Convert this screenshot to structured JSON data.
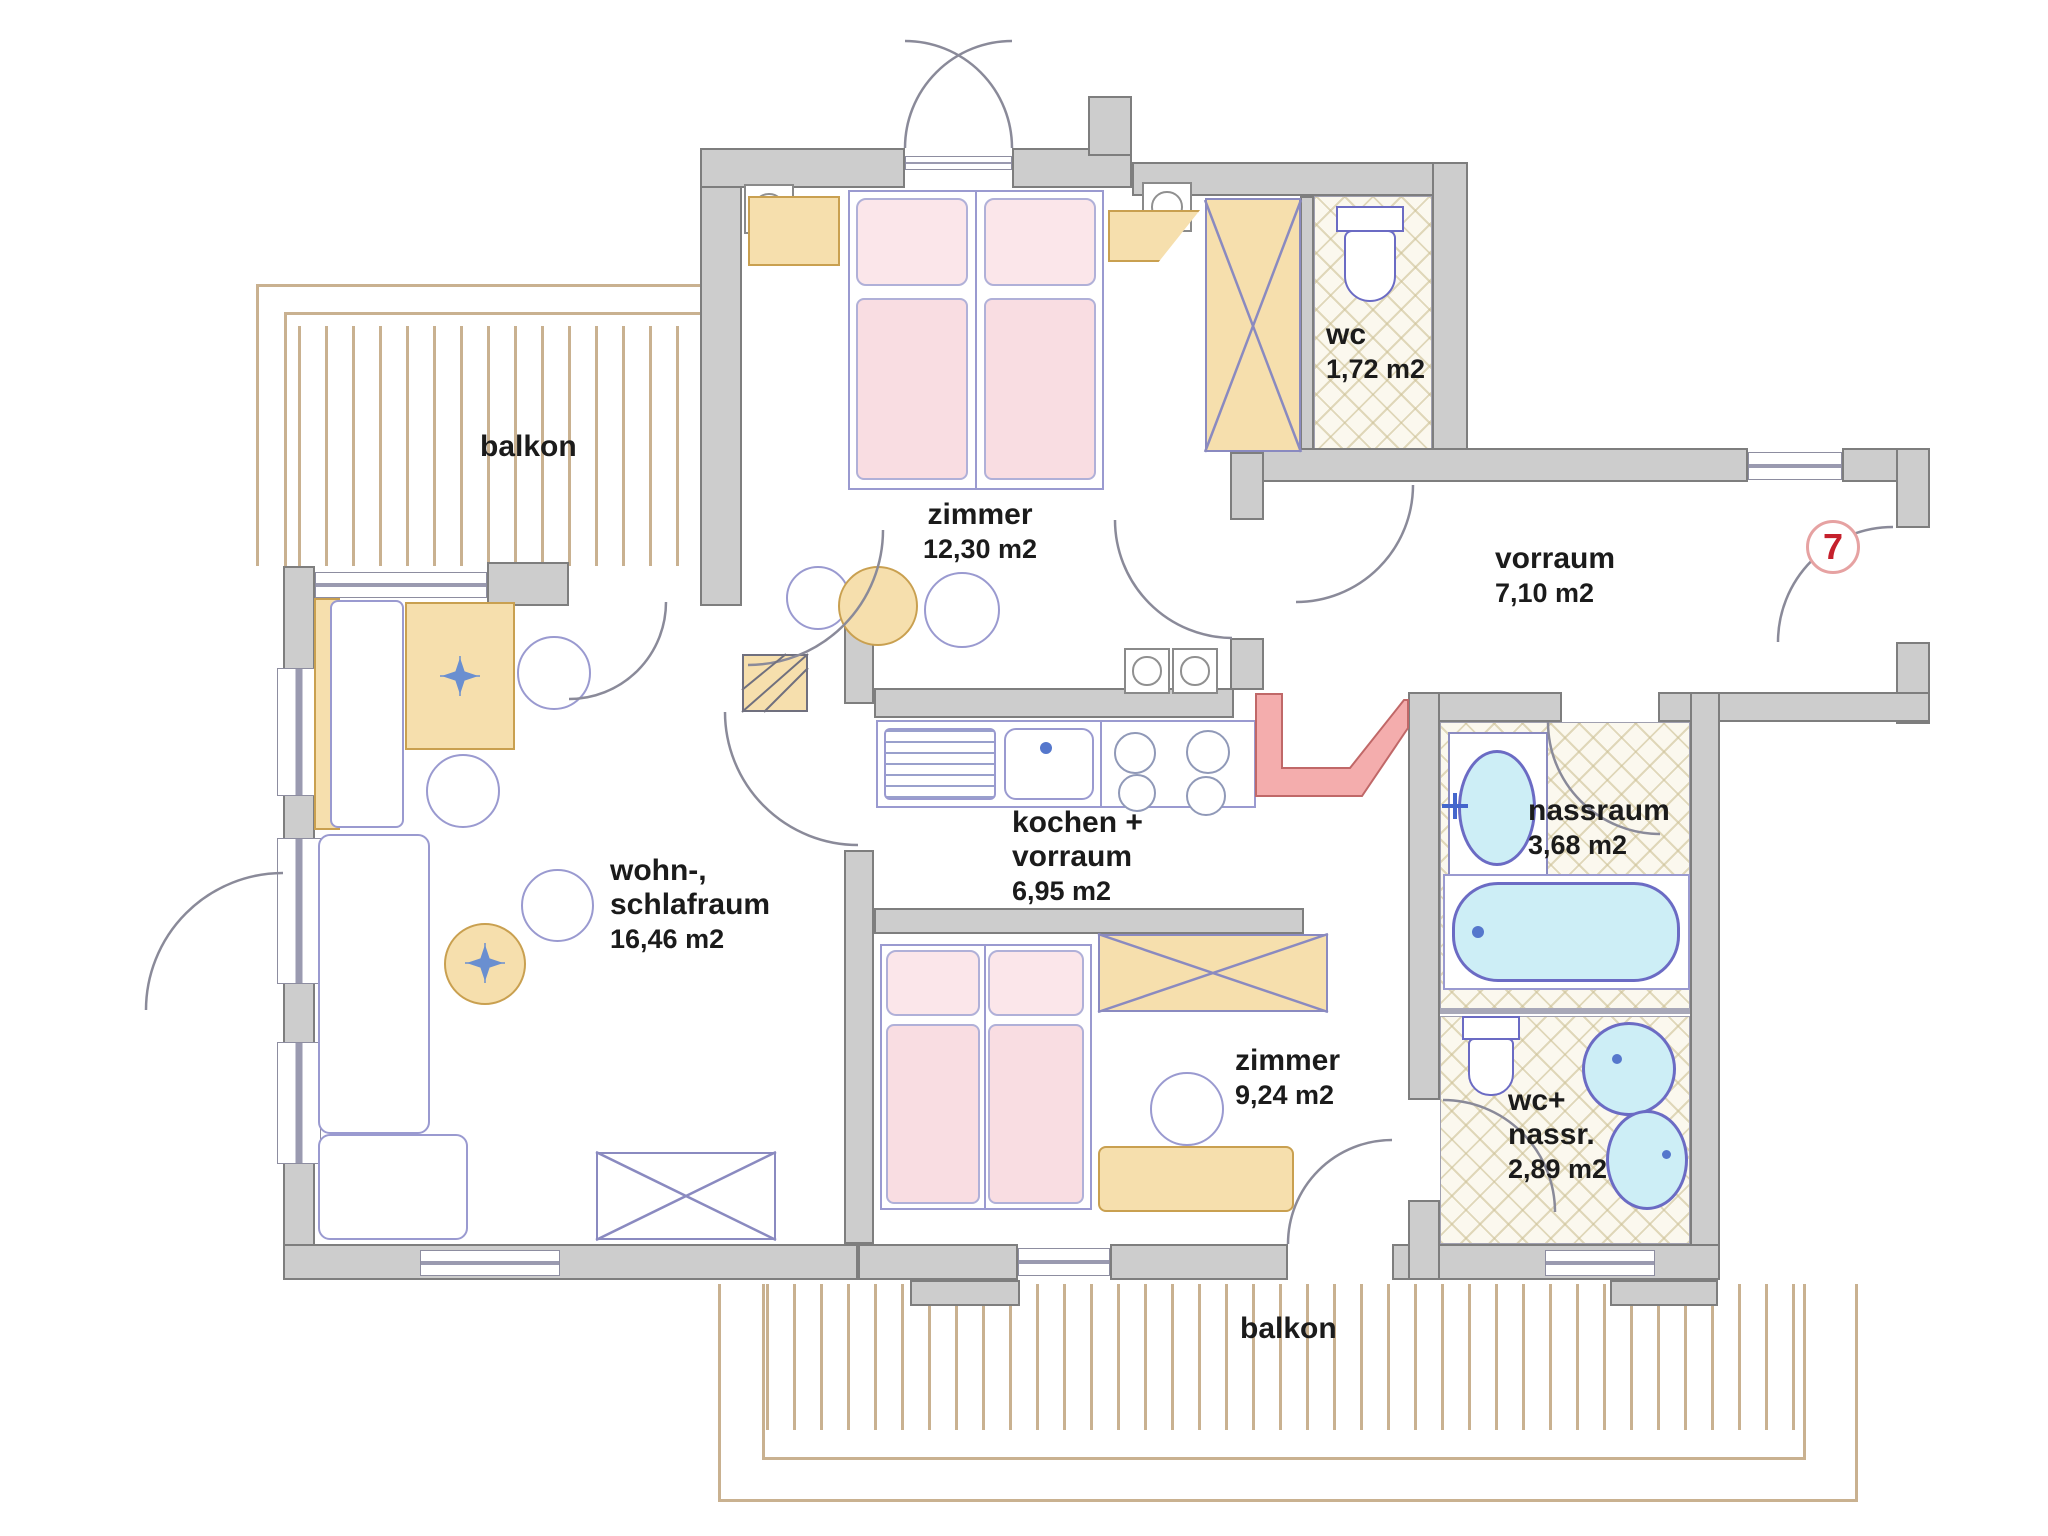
{
  "title": "apartment floor plan",
  "unit": {
    "number": "7"
  },
  "rooms": {
    "zimmer1": {
      "name": "zimmer",
      "area": "12,30 m2"
    },
    "wc": {
      "name": "wc",
      "area": "1,72 m2"
    },
    "vorraum": {
      "name": "vorraum",
      "area": "7,10 m2"
    },
    "wohn_schlafraum": {
      "line1": "wohn-,",
      "line2": "schlafraum",
      "area": "16,46 m2"
    },
    "kochen_vorraum": {
      "line1": "kochen +",
      "line2": "vorraum",
      "area": "6,95 m2"
    },
    "zimmer2": {
      "name": "zimmer",
      "area": "9,24 m2"
    },
    "nassraum": {
      "name": "nassraum",
      "area": "3,68 m2"
    },
    "wc_nassraum": {
      "line1": "wc+",
      "line2": "nassr.",
      "area": "2,89 m2"
    }
  },
  "balconies": {
    "top": "balkon",
    "bottom": "balkon"
  },
  "colors": {
    "wall_fill": "#cdcdcd",
    "wall_edge": "#7e7e7e",
    "wood": "#f6dfad",
    "bed_pink": "#f9dde2",
    "fixture_blue": "#cdeef6",
    "line_purple": "#9a9ad0",
    "balcony_tan": "#c9b190",
    "brick_red": "#f2a6a6",
    "unit_red": "#c5202c"
  }
}
